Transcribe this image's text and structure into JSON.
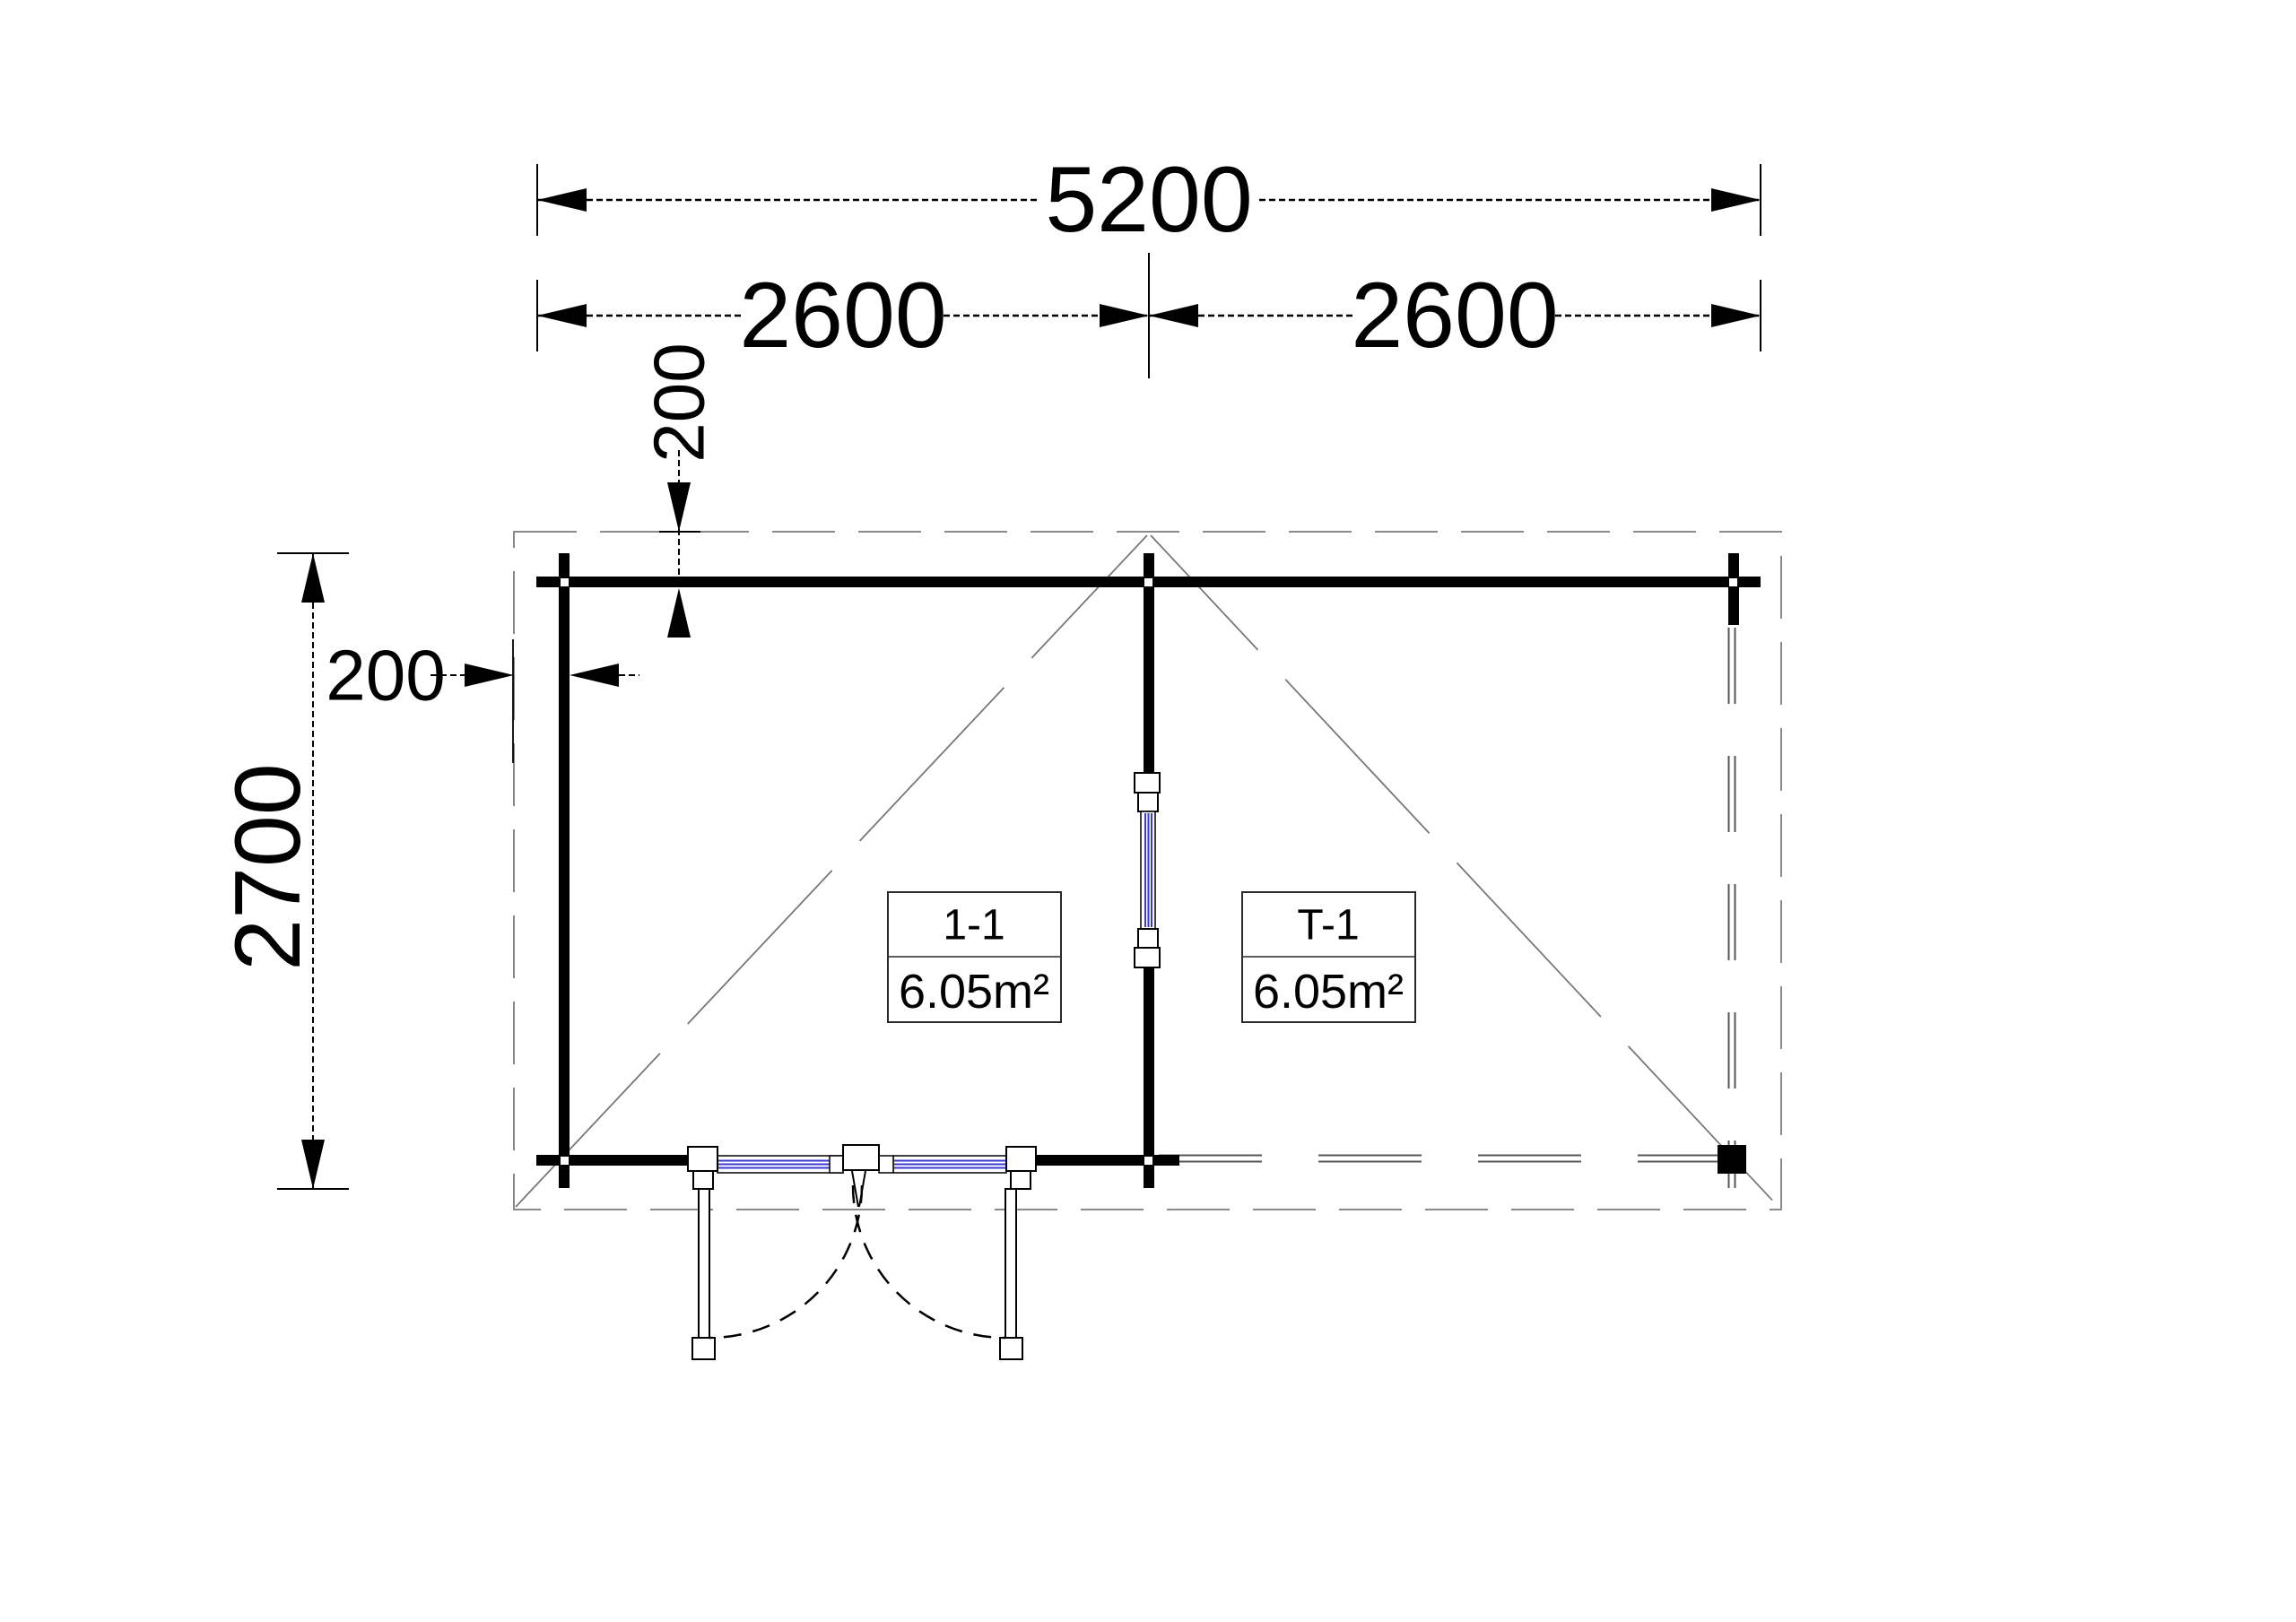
{
  "plan": {
    "type": "floor-plan",
    "dimensions": {
      "overall_width": "5200",
      "left_bay_width": "2600",
      "right_bay_width": "2600",
      "overall_depth": "2700",
      "eave_offset_top": "200",
      "eave_offset_left": "200"
    },
    "rooms": [
      {
        "label": "1-1",
        "area": "6.05m²"
      },
      {
        "label": "T-1",
        "area": "6.05m²"
      }
    ],
    "colors": {
      "wall": "#000000",
      "glazing_blue": "#3a3ad2",
      "thin_edge_gray": "#555555",
      "roof_outline_gray": "#8a8a8a",
      "slope_line_gray": "#787878"
    }
  }
}
